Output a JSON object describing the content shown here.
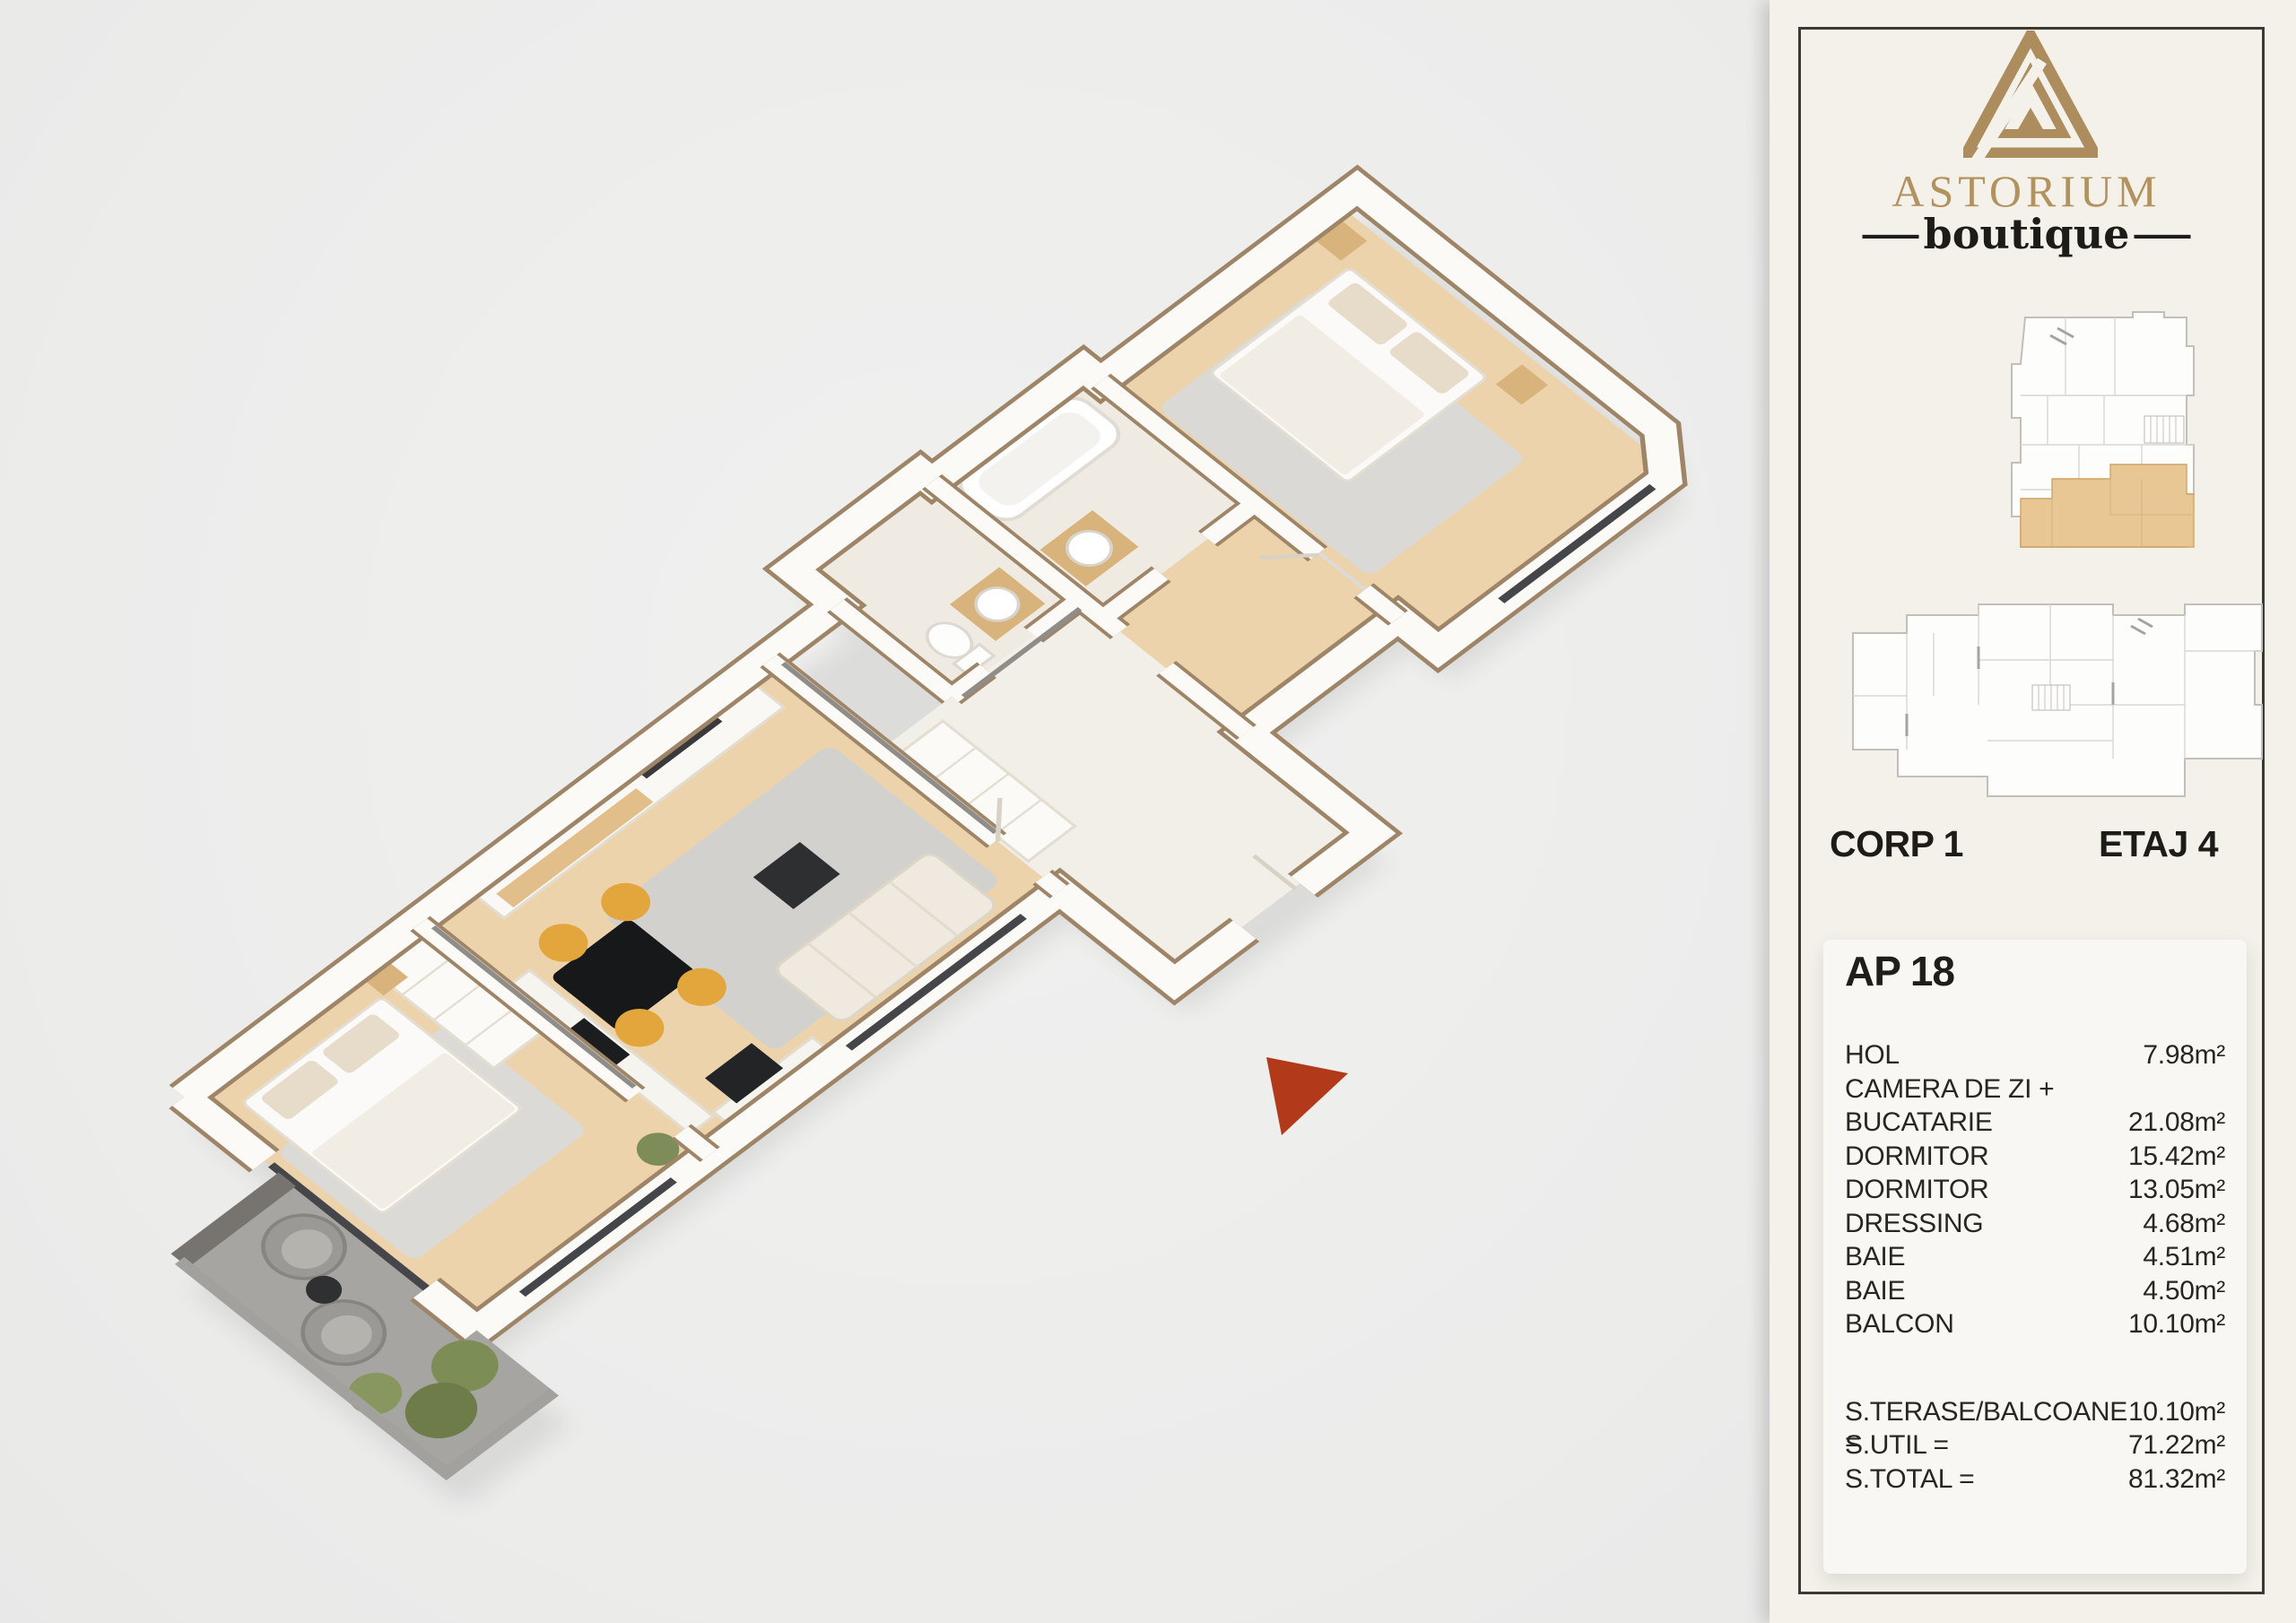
{
  "sidebar": {
    "brand": {
      "name": "ASTORIUM",
      "tagline": "boutique",
      "dash": "—"
    },
    "locator": {
      "corp": "CORP 1",
      "etaj": "ETAJ 4"
    },
    "apartment": {
      "title": "AP 18",
      "rooms": [
        {
          "label": "HOL",
          "area": "7.98m²"
        },
        {
          "label": "CAMERA DE ZI +",
          "area": ""
        },
        {
          "label": "BUCATARIE",
          "area": "21.08m²"
        },
        {
          "label": "DORMITOR",
          "area": "15.42m²"
        },
        {
          "label": "DORMITOR",
          "area": "13.05m²"
        },
        {
          "label": "DRESSING",
          "area": "4.68m²"
        },
        {
          "label": "BAIE",
          "area": "4.51m²"
        },
        {
          "label": "BAIE",
          "area": "4.50m²"
        },
        {
          "label": "BALCON",
          "area": "10.10m²"
        }
      ],
      "totals": [
        {
          "label": "S.TERASE/BALCOANE =",
          "area": "10.10m²"
        },
        {
          "label": "S.UTIL =",
          "area": "71.22m²"
        },
        {
          "label": "S.TOTAL =",
          "area": "81.32m²"
        }
      ]
    }
  },
  "colors": {
    "accent_gold": "#b2925f",
    "frame_dark": "#3c3930",
    "sidebar_cream": "#f4f1ea",
    "card_white": "#f8f7f3",
    "entrance_arrow_red": "#b23a1b",
    "wood_floor": "#ecd3ab",
    "balcony_gray": "#a7a5a2",
    "wall_trim_tan": "#9f8568",
    "locator_highlight": "#e9c795"
  }
}
